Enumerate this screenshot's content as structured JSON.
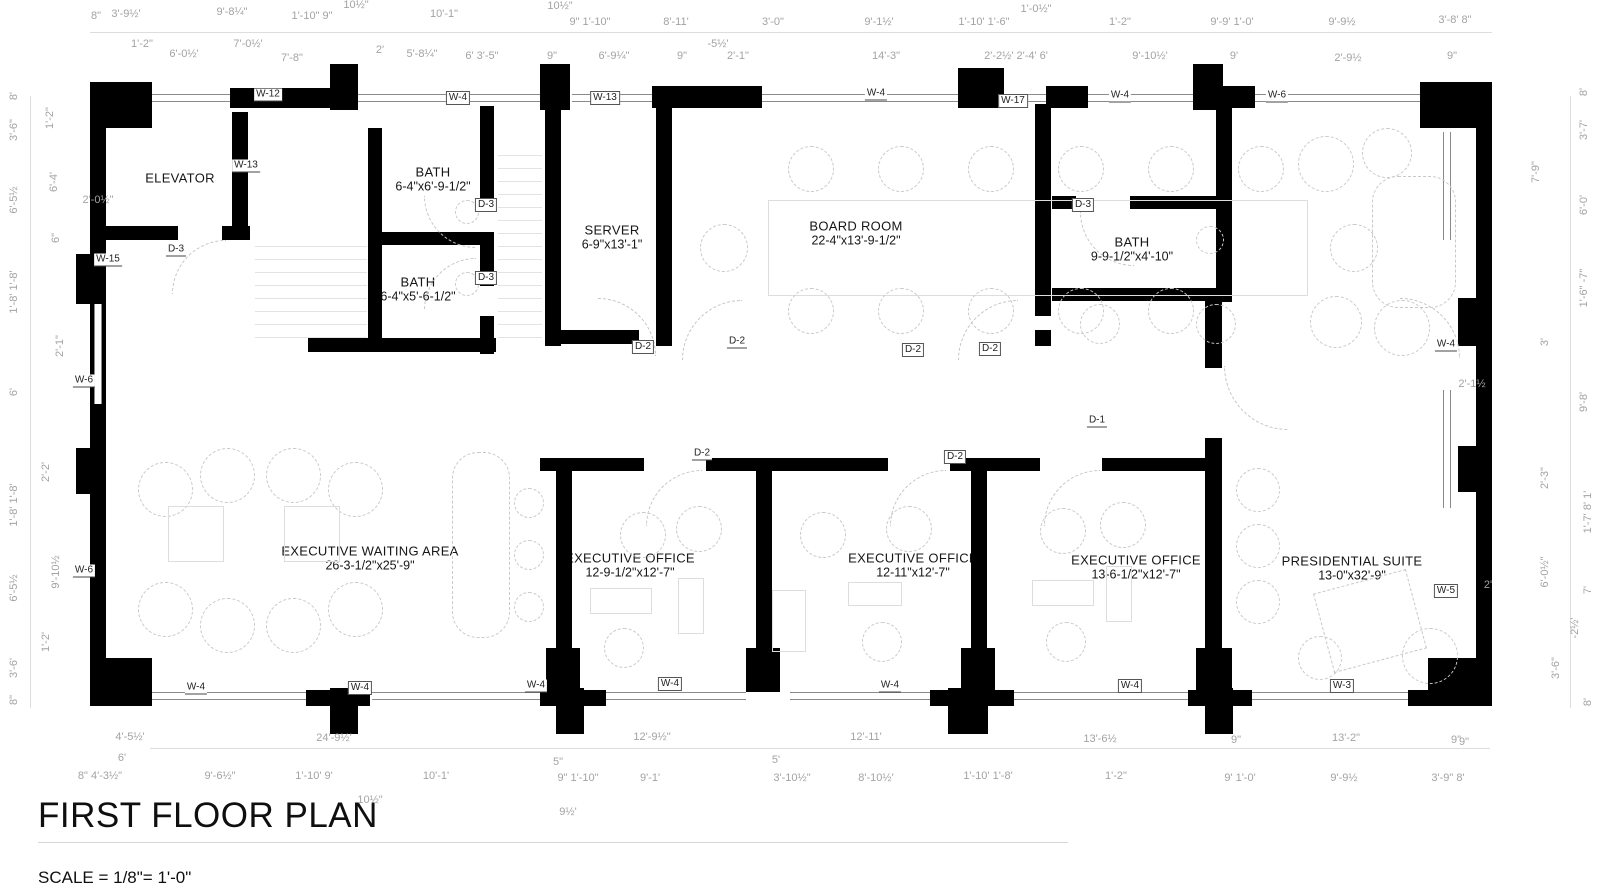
{
  "title": {
    "text": "FIRST FLOOR PLAN",
    "scale": "SCALE = 1/8\"= 1'-0\""
  },
  "colors": {
    "wall": "#000000",
    "dim_text": "#a3a3a3",
    "tag_text": "#222222",
    "furniture": "#c9c9c9"
  },
  "rooms": [
    {
      "name": "ELEVATOR",
      "dims": ""
    },
    {
      "name": "BATH",
      "dims": "6-4\"x6'-9-1/2\""
    },
    {
      "name": "BATH",
      "dims": "6-4\"x5'-6-1/2\""
    },
    {
      "name": "SERVER",
      "dims": "6-9\"x13'-1\""
    },
    {
      "name": "BOARD ROOM",
      "dims": "22-4\"x13'-9-1/2\""
    },
    {
      "name": "BATH",
      "dims": "9-9-1/2\"x4'-10\""
    },
    {
      "name": "EXECUTIVE WAITING AREA",
      "dims": "26-3-1/2\"x25'-9\""
    },
    {
      "name": "EXECUTIVE OFFICE",
      "dims": "12-9-1/2\"x12'-7\""
    },
    {
      "name": "EXECUTIVE OFFICE",
      "dims": "12-11\"x12'-7\""
    },
    {
      "name": "EXECUTIVE OFFICE",
      "dims": "13-6-1/2\"x12'-7\""
    },
    {
      "name": "PRESIDENTIAL SUITE",
      "dims": "13-0\"x32'-9\""
    }
  ],
  "tags": [
    [
      "W-12",
      268,
      95,
      "u",
      "wall-tag"
    ],
    [
      "W-4",
      458,
      98,
      "b",
      "wall-tag"
    ],
    [
      "W-13",
      605,
      98,
      "b",
      "wall-tag"
    ],
    [
      "W-4",
      876,
      94,
      "u",
      "wall-tag"
    ],
    [
      "W-17",
      1013,
      101,
      "b",
      "wall-tag"
    ],
    [
      "W-4",
      1120,
      96,
      "u",
      "wall-tag"
    ],
    [
      "W-6",
      1277,
      96,
      "u",
      "wall-tag"
    ],
    [
      "W-13",
      246,
      166,
      "u",
      "wall-tag"
    ],
    [
      "W-15",
      108,
      260,
      "u",
      "wall-tag"
    ],
    [
      "W-6",
      84,
      381,
      "u",
      "wall-tag"
    ],
    [
      "W-6",
      84,
      571,
      "u",
      "wall-tag"
    ],
    [
      "W-4",
      1446,
      345,
      "u",
      "wall-tag"
    ],
    [
      "W-5",
      1446,
      591,
      "b",
      "wall-tag"
    ],
    [
      "W-4",
      196,
      688,
      "u",
      "wall-tag"
    ],
    [
      "W-4",
      360,
      688,
      "b",
      "wall-tag"
    ],
    [
      "W-4",
      536,
      686,
      "u",
      "wall-tag"
    ],
    [
      "W-4",
      670,
      684,
      "b",
      "wall-tag"
    ],
    [
      "W-4",
      890,
      686,
      "u",
      "wall-tag"
    ],
    [
      "W-4",
      1130,
      686,
      "b",
      "wall-tag"
    ],
    [
      "W-3",
      1342,
      686,
      "b",
      "wall-tag"
    ],
    [
      "D-3",
      176,
      250,
      "u",
      "door-tag"
    ],
    [
      "D-3",
      486,
      205,
      "b",
      "door-tag"
    ],
    [
      "D-3",
      486,
      278,
      "b",
      "door-tag"
    ],
    [
      "D-2",
      643,
      347,
      "b",
      "door-tag"
    ],
    [
      "D-2",
      737,
      342,
      "u",
      "door-tag"
    ],
    [
      "D-2",
      913,
      350,
      "b",
      "door-tag"
    ],
    [
      "D-2",
      990,
      349,
      "b",
      "door-tag"
    ],
    [
      "D-3",
      1083,
      205,
      "b",
      "door-tag"
    ],
    [
      "D-1",
      1097,
      421,
      "u",
      "door-tag"
    ],
    [
      "D-2",
      702,
      454,
      "u",
      "door-tag"
    ],
    [
      "D-2",
      955,
      457,
      "b",
      "door-tag"
    ]
  ],
  "dims": [
    [
      "8\"",
      96,
      16
    ],
    [
      "3'-9½'",
      126,
      14
    ],
    [
      "9'-8¼\"",
      232,
      12
    ],
    [
      "1'-10\" 9\"",
      312,
      16
    ],
    [
      "10½\"",
      356,
      5
    ],
    [
      "10'-1\"",
      444,
      14
    ],
    [
      "10½\"",
      560,
      6
    ],
    [
      "9\" 1'-10\"",
      590,
      22
    ],
    [
      "8'-11'",
      676,
      22
    ],
    [
      "3'-0\"",
      773,
      22
    ],
    [
      "9'-1½'",
      879,
      22
    ],
    [
      "1'-10' 1'-6\"",
      984,
      22
    ],
    [
      "1'-0½\"",
      1036,
      9
    ],
    [
      "1'-2\"",
      1120,
      22
    ],
    [
      "9'-9' 1'-0'",
      1232,
      22
    ],
    [
      "9'-9½",
      1342,
      22
    ],
    [
      "3'-8'  8\"",
      1455,
      20
    ],
    [
      "1'-2\"",
      142,
      44
    ],
    [
      "6'-0½'",
      184,
      54
    ],
    [
      "7'-0½'",
      248,
      44
    ],
    [
      "7'-8\"",
      292,
      58
    ],
    [
      "2'",
      380,
      50
    ],
    [
      "5'-8¼\"",
      422,
      54
    ],
    [
      "6' 3'-5\"",
      482,
      56
    ],
    [
      "9\"",
      552,
      56
    ],
    [
      "6'-9¼\"",
      614,
      56
    ],
    [
      "9\"",
      682,
      56
    ],
    [
      "-5½'",
      718,
      44
    ],
    [
      "2'-1\"",
      738,
      56
    ],
    [
      "14'-3\"",
      886,
      56
    ],
    [
      "2'-2½' 2'-4' 6'",
      1016,
      56
    ],
    [
      "9'-10½'",
      1150,
      56
    ],
    [
      "9'",
      1234,
      56
    ],
    [
      "2'-9½",
      1348,
      58
    ],
    [
      "9\"",
      1452,
      56
    ],
    [
      "4'-5½'",
      130,
      737
    ],
    [
      "24'-9½'",
      334,
      738
    ],
    [
      "12'-9½\"",
      652,
      737
    ],
    [
      "12'-11'",
      866,
      737
    ],
    [
      "13'-6½",
      1100,
      739
    ],
    [
      "9\"",
      1236,
      740
    ],
    [
      "13'-2\"",
      1346,
      738
    ],
    [
      "9\"",
      1456,
      740
    ],
    [
      "8\" 4'-3½\"",
      100,
      776
    ],
    [
      "6'",
      122,
      758
    ],
    [
      "9'-6½\"",
      220,
      776
    ],
    [
      "1'-10' 9'",
      314,
      776
    ],
    [
      "10'-1'",
      436,
      776
    ],
    [
      "5\"",
      558,
      762
    ],
    [
      "9\" 1'-10\"",
      578,
      778
    ],
    [
      "9'-1'",
      650,
      778
    ],
    [
      "5'",
      776,
      760
    ],
    [
      "3'-10½\"",
      792,
      778
    ],
    [
      "8'-10½'",
      876,
      778
    ],
    [
      "1'-10' 1'-8'",
      988,
      776
    ],
    [
      "1'-2\"",
      1116,
      776
    ],
    [
      "9' 1'-0'",
      1240,
      778
    ],
    [
      "9'-9½",
      1344,
      778
    ],
    [
      "3'-9\"  8'",
      1448,
      778
    ],
    [
      "10½\"",
      370,
      800
    ],
    [
      "9½'",
      568,
      812
    ],
    [
      "8'",
      14,
      96,
      1
    ],
    [
      "3'-6\"",
      14,
      130,
      1
    ],
    [
      "6'-5½",
      14,
      200,
      1
    ],
    [
      "1'-8' 1'-8'",
      14,
      292,
      1
    ],
    [
      "6'",
      14,
      392,
      1
    ],
    [
      "1'-8' 1'-8'",
      14,
      505,
      1
    ],
    [
      "6'-5½",
      14,
      588,
      1
    ],
    [
      "3'-6'",
      14,
      668,
      1
    ],
    [
      "8\"",
      14,
      700,
      1
    ],
    [
      "1'-2\"",
      50,
      118,
      1
    ],
    [
      "6'-4'",
      54,
      182,
      1
    ],
    [
      "6\"",
      56,
      238,
      1
    ],
    [
      "2'-1\"",
      60,
      346,
      1
    ],
    [
      "2'-2'",
      46,
      472,
      1
    ],
    [
      "9'-10½",
      56,
      572,
      1
    ],
    [
      "1'-2'",
      46,
      642,
      1
    ],
    [
      "2'-0½\"",
      98,
      200
    ],
    [
      "8'",
      1584,
      92,
      1
    ],
    [
      "3'-7'",
      1584,
      130,
      1
    ],
    [
      "6'-0'",
      1584,
      205,
      1
    ],
    [
      "1'-6\" -7\"",
      1584,
      288,
      1
    ],
    [
      "3'",
      1545,
      342,
      1
    ],
    [
      "9'-8'",
      1584,
      402,
      1
    ],
    [
      "2'-3\"",
      1545,
      478,
      1
    ],
    [
      "1'-7' 8' 1'",
      1588,
      512,
      1
    ],
    [
      "6'-0½\"",
      1545,
      572,
      1
    ],
    [
      "7'",
      1588,
      590,
      1
    ],
    [
      "-2½'",
      1575,
      628,
      1
    ],
    [
      "3'-6\"",
      1556,
      668,
      1
    ],
    [
      "8'",
      1588,
      702,
      1
    ],
    [
      "7'-9\"",
      1536,
      172,
      1
    ],
    [
      "2'-1½",
      1472,
      384
    ],
    [
      "2'",
      1488,
      585
    ],
    [
      "9\"",
      1464,
      742
    ]
  ],
  "geometry": {
    "walls": [
      [
        90,
        82,
        62,
        46
      ],
      [
        230,
        88,
        116,
        20
      ],
      [
        330,
        64,
        28,
        46
      ],
      [
        540,
        64,
        30,
        46
      ],
      [
        652,
        86,
        110,
        22
      ],
      [
        958,
        68,
        46,
        40
      ],
      [
        1046,
        86,
        42,
        22
      ],
      [
        1193,
        64,
        30,
        46
      ],
      [
        1193,
        86,
        62,
        22
      ],
      [
        1420,
        82,
        72,
        46
      ],
      [
        90,
        82,
        16,
        624
      ],
      [
        76,
        254,
        30,
        50
      ],
      [
        76,
        448,
        30,
        46
      ],
      [
        90,
        658,
        62,
        48
      ],
      [
        1476,
        82,
        16,
        624
      ],
      [
        1458,
        298,
        34,
        48
      ],
      [
        1458,
        446,
        34,
        46
      ],
      [
        1428,
        658,
        64,
        48
      ],
      [
        330,
        688,
        28,
        46
      ],
      [
        556,
        688,
        28,
        46
      ],
      [
        948,
        688,
        40,
        46
      ],
      [
        1205,
        688,
        28,
        46
      ],
      [
        306,
        690,
        64,
        16
      ],
      [
        540,
        690,
        66,
        16
      ],
      [
        930,
        690,
        84,
        16
      ],
      [
        1188,
        690,
        64,
        16
      ],
      [
        1408,
        690,
        60,
        16
      ],
      [
        232,
        112,
        16,
        128
      ],
      [
        106,
        226,
        72,
        14
      ],
      [
        222,
        226,
        28,
        14
      ],
      [
        368,
        128,
        14,
        224
      ],
      [
        368,
        232,
        126,
        13
      ],
      [
        480,
        106,
        14,
        94
      ],
      [
        480,
        244,
        14,
        42
      ],
      [
        480,
        316,
        14,
        38
      ],
      [
        308,
        338,
        188,
        14
      ],
      [
        545,
        104,
        16,
        242
      ],
      [
        656,
        104,
        16,
        242
      ],
      [
        545,
        330,
        94,
        14
      ],
      [
        1035,
        104,
        16,
        212
      ],
      [
        1035,
        330,
        16,
        16
      ],
      [
        1052,
        196,
        24,
        13
      ],
      [
        1130,
        196,
        100,
        13
      ],
      [
        1216,
        104,
        16,
        198
      ],
      [
        1052,
        288,
        172,
        13
      ],
      [
        1205,
        300,
        17,
        68
      ],
      [
        556,
        458,
        16,
        234
      ],
      [
        756,
        458,
        16,
        234
      ],
      [
        971,
        458,
        16,
        234
      ],
      [
        1205,
        438,
        17,
        254
      ],
      [
        540,
        458,
        104,
        13
      ],
      [
        706,
        458,
        182,
        13
      ],
      [
        950,
        458,
        90,
        13
      ],
      [
        1102,
        458,
        120,
        13
      ],
      [
        546,
        648,
        34,
        44
      ],
      [
        746,
        648,
        34,
        44
      ],
      [
        961,
        648,
        34,
        44
      ],
      [
        1196,
        648,
        36,
        44
      ]
    ],
    "windows": [
      [
        152,
        94,
        78,
        "h"
      ],
      [
        358,
        94,
        182,
        "h"
      ],
      [
        572,
        94,
        80,
        "h"
      ],
      [
        762,
        94,
        196,
        "h"
      ],
      [
        1004,
        94,
        42,
        "h"
      ],
      [
        1088,
        94,
        105,
        "h"
      ],
      [
        1255,
        94,
        80,
        "h"
      ],
      [
        1335,
        94,
        85,
        "h"
      ],
      [
        152,
        692,
        154,
        "h"
      ],
      [
        372,
        692,
        168,
        "h"
      ],
      [
        606,
        692,
        140,
        "h"
      ],
      [
        790,
        692,
        140,
        "h"
      ],
      [
        1014,
        692,
        174,
        "h"
      ],
      [
        1252,
        692,
        156,
        "h"
      ],
      [
        1443,
        132,
        108,
        "v"
      ],
      [
        1443,
        390,
        118,
        "v"
      ],
      [
        94,
        304,
        100,
        "v"
      ]
    ],
    "lines": [
      [
        90,
        32,
        1402,
        "h"
      ],
      [
        150,
        748,
        1340,
        "h"
      ],
      [
        30,
        96,
        612,
        "v"
      ],
      [
        1570,
        96,
        612,
        "v"
      ]
    ],
    "stairs": [
      [
        255,
        246,
        112,
        94
      ],
      [
        498,
        155,
        44,
        185
      ]
    ],
    "arcs": [
      [
        172,
        240,
        54,
        "tl"
      ],
      [
        424,
        196,
        52,
        "bl"
      ],
      [
        424,
        258,
        52,
        "tl"
      ],
      [
        598,
        298,
        58,
        "tr"
      ],
      [
        682,
        300,
        60,
        "tl"
      ],
      [
        958,
        300,
        60,
        "tl"
      ],
      [
        1400,
        298,
        60,
        "tr"
      ],
      [
        1080,
        212,
        54,
        "bl"
      ],
      [
        1224,
        366,
        64,
        "bl"
      ],
      [
        646,
        470,
        56,
        "tl"
      ],
      [
        890,
        470,
        56,
        "tl"
      ],
      [
        1044,
        470,
        56,
        "tl"
      ]
    ],
    "furniture": [
      [
        "s",
        768,
        200,
        540,
        96
      ],
      [
        "c",
        788,
        146,
        46
      ],
      [
        "c",
        878,
        146,
        46
      ],
      [
        "c",
        968,
        146,
        46
      ],
      [
        "c",
        1058,
        146,
        46
      ],
      [
        "c",
        1148,
        146,
        46
      ],
      [
        "c",
        1238,
        146,
        46
      ],
      [
        "c",
        788,
        288,
        46
      ],
      [
        "c",
        878,
        288,
        46
      ],
      [
        "c",
        968,
        288,
        46
      ],
      [
        "c",
        1058,
        288,
        46
      ],
      [
        "c",
        1148,
        288,
        46
      ],
      [
        "c",
        700,
        224,
        48
      ],
      [
        "c",
        1330,
        224,
        48
      ],
      [
        "c",
        138,
        462,
        55
      ],
      [
        "c",
        200,
        448,
        55
      ],
      [
        "c",
        266,
        448,
        55
      ],
      [
        "c",
        328,
        462,
        55
      ],
      [
        "c",
        138,
        582,
        55
      ],
      [
        "c",
        200,
        598,
        55
      ],
      [
        "c",
        266,
        598,
        55
      ],
      [
        "c",
        328,
        582,
        55
      ],
      [
        "s",
        168,
        506,
        56,
        56
      ],
      [
        "s",
        284,
        506,
        56,
        56
      ],
      [
        "rr",
        452,
        452,
        58,
        186
      ],
      [
        "c",
        514,
        488,
        30
      ],
      [
        "c",
        514,
        540,
        30
      ],
      [
        "c",
        514,
        592,
        30
      ],
      [
        "c",
        620,
        512,
        46
      ],
      [
        "c",
        676,
        506,
        46
      ],
      [
        "s",
        590,
        588,
        62,
        26
      ],
      [
        "c",
        604,
        628,
        40
      ],
      [
        "s",
        678,
        578,
        26,
        56
      ],
      [
        "c",
        800,
        512,
        46
      ],
      [
        "c",
        886,
        506,
        46
      ],
      [
        "s",
        848,
        582,
        54,
        24
      ],
      [
        "c",
        862,
        622,
        40
      ],
      [
        "s",
        772,
        590,
        34,
        62
      ],
      [
        "c",
        1040,
        508,
        46
      ],
      [
        "c",
        1100,
        502,
        46
      ],
      [
        "s",
        1032,
        580,
        62,
        26
      ],
      [
        "c",
        1046,
        622,
        40
      ],
      [
        "s",
        1106,
        566,
        26,
        56
      ],
      [
        "c",
        1298,
        136,
        56
      ],
      [
        "c",
        1362,
        128,
        50
      ],
      [
        "rr",
        1372,
        176,
        84,
        132
      ],
      [
        "c",
        1310,
        296,
        52
      ],
      [
        "c",
        1374,
        300,
        56
      ],
      [
        "r",
        1322,
        580,
        96,
        82,
        -15
      ],
      [
        "c",
        1402,
        628,
        56
      ],
      [
        "c",
        1298,
        636,
        44
      ],
      [
        "c",
        1236,
        468,
        44
      ],
      [
        "c",
        1236,
        524,
        44
      ],
      [
        "c",
        1236,
        580,
        44
      ],
      [
        "c",
        1080,
        304,
        40
      ],
      [
        "c",
        1196,
        304,
        40
      ],
      [
        "c",
        455,
        200,
        24
      ],
      [
        "c",
        455,
        272,
        24
      ],
      [
        "c",
        1196,
        226,
        28
      ]
    ]
  }
}
